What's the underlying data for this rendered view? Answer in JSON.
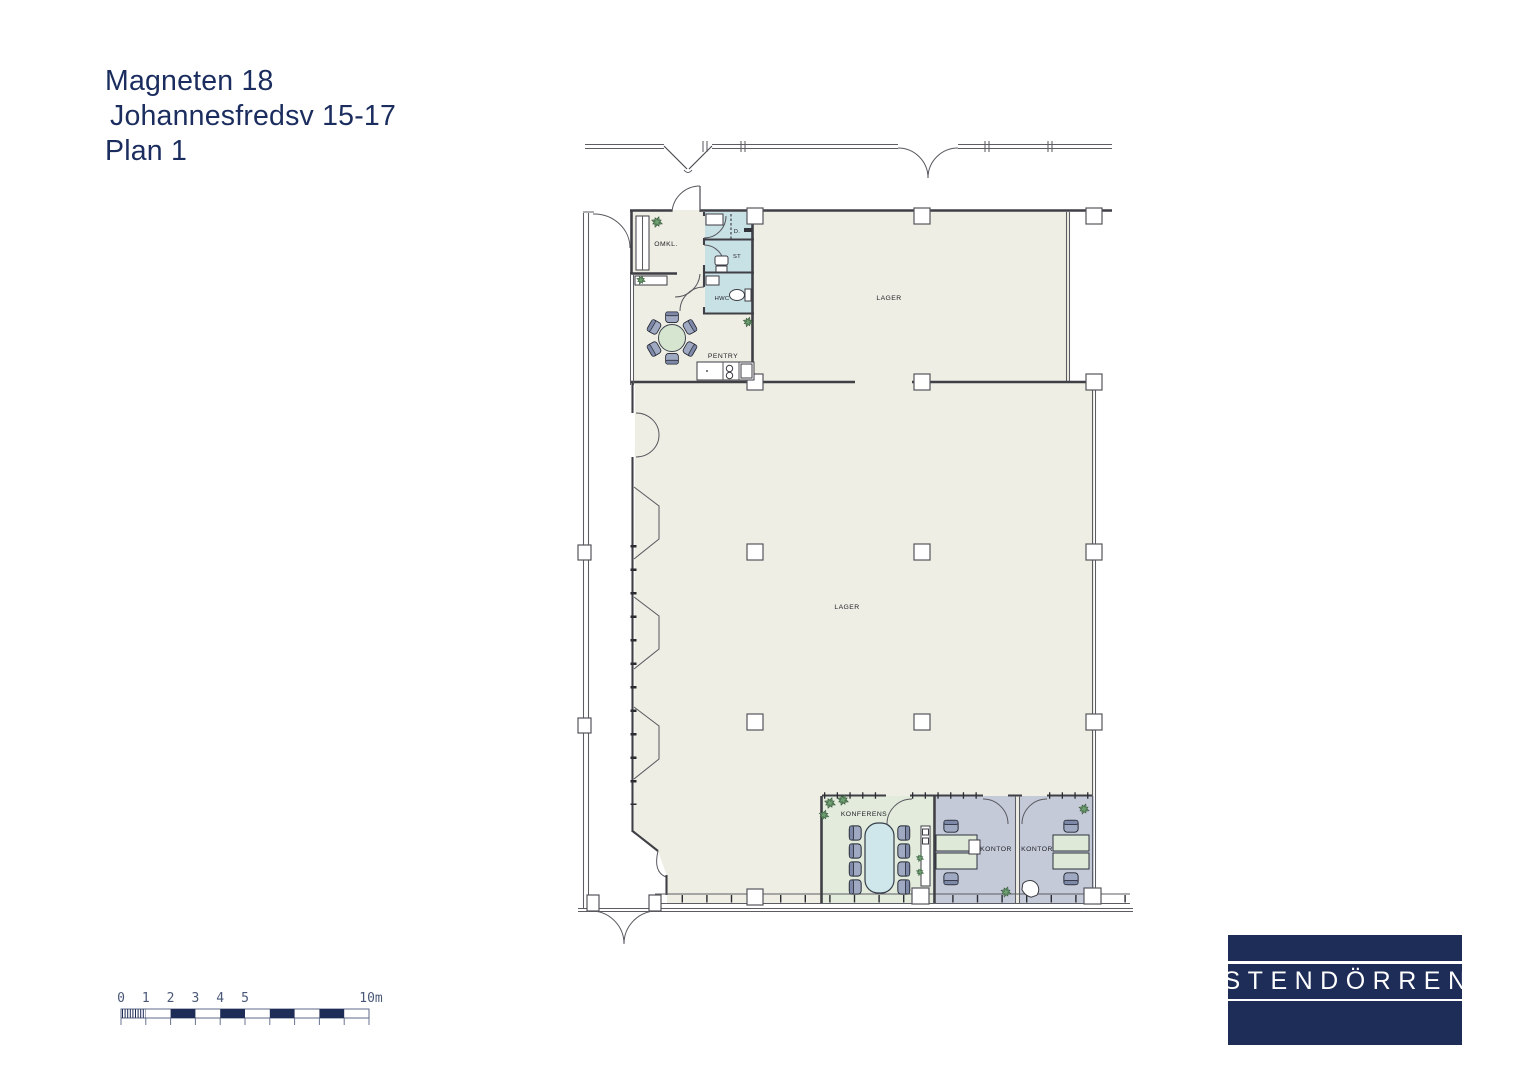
{
  "title": {
    "line1": "Magneten 18",
    "line2": "Johannesfredsv 15-17",
    "line3": "Plan 1"
  },
  "plan": {
    "labels": {
      "omkl": "OMKL.",
      "dusch": "D.",
      "st": "ST",
      "hwc": "HWC",
      "pentry": "PENTRY",
      "lager_upper": "LAGER",
      "lager_main": "LAGER",
      "konferens": "KONFERENS",
      "kontor_left": "KONTOR",
      "kontor_right": "KONTOR"
    }
  },
  "scale_bar": {
    "tick_labels": [
      "0",
      "1",
      "2",
      "3",
      "4",
      "5"
    ],
    "end_label": "10m"
  },
  "logo": {
    "text": "STENDÖRREN"
  },
  "colors": {
    "title_text": "#1b2d5e",
    "logo_bg": "#1e2c58",
    "logo_text": "#ffffff",
    "floor": "#eeeee4",
    "wet_room": "#c8e1e5",
    "conference_room": "#e2ebdc",
    "office_room": "#c5cad9",
    "table_top": "#cfe7ea",
    "desk_top": "#dfe9d8",
    "round_table": "#d6e5cf",
    "chair": "#9fa9c2",
    "plant": "#6fa072",
    "wall": "#3f3f46",
    "scale_fill": "#1e2c58",
    "scale_text": "#4a5878"
  }
}
